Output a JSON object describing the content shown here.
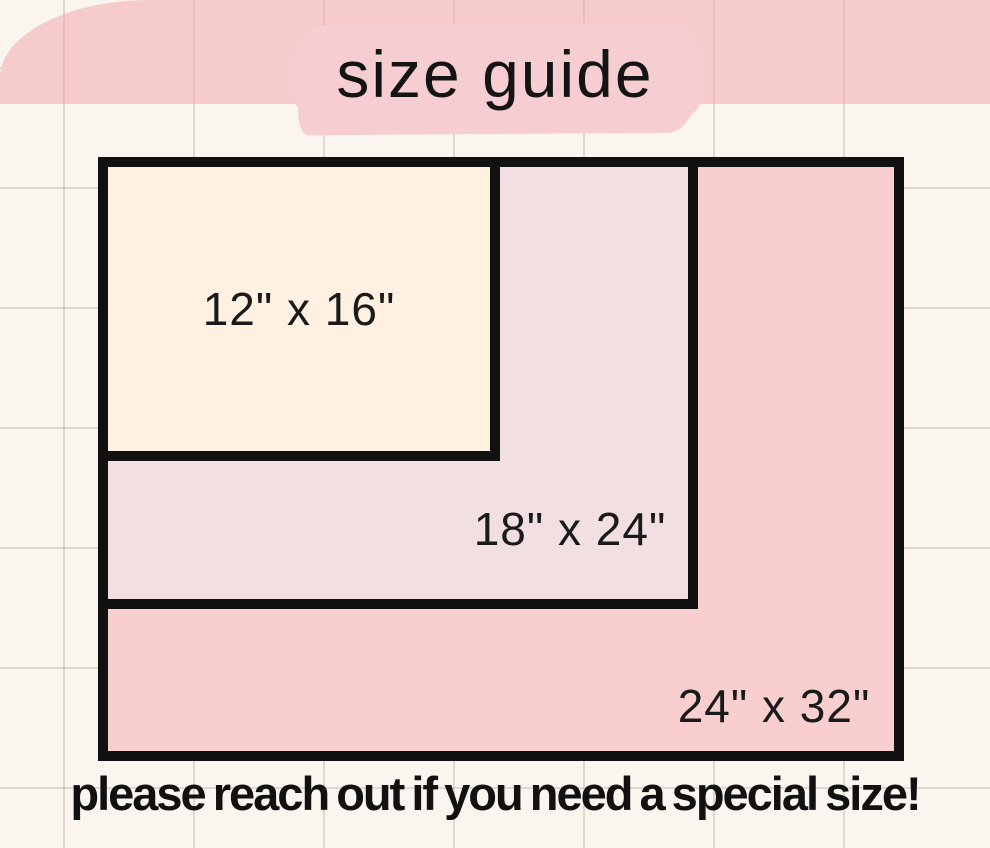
{
  "title": {
    "text": "size guide"
  },
  "diagram": {
    "sizes": [
      {
        "id": "12x16",
        "label": "12\" x 16\"",
        "width_in": 16,
        "height_in": 12,
        "fill": "#FEF1E1"
      },
      {
        "id": "18x24",
        "label": "18\" x 24\"",
        "width_in": 24,
        "height_in": 18,
        "fill": "#F2DFE2"
      },
      {
        "id": "24x32",
        "label": "24\" x 32\"",
        "width_in": 32,
        "height_in": 24,
        "fill": "#F8CECF"
      }
    ],
    "border_color": "#111111"
  },
  "footer": {
    "text": "please reach out if you need a special size!"
  },
  "colors": {
    "background": "#FBF5EF",
    "grid_line": "#E2DED6",
    "title_highlight": "#F6CDD1",
    "footer_blob": "#F5CBCB",
    "text": "#111111"
  }
}
